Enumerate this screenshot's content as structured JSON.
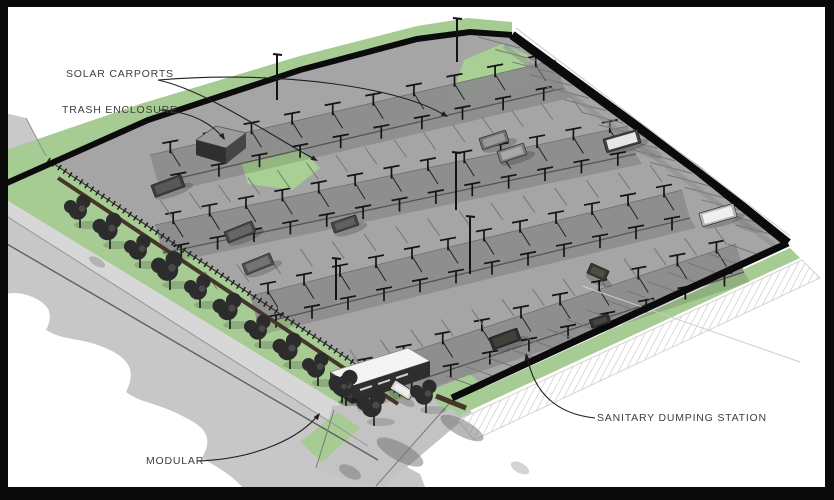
{
  "labels": [
    {
      "id": "solar-carports",
      "text": "SOLAR CARPORTS",
      "x": 66,
      "y": 68
    },
    {
      "id": "trash-enclosure",
      "text": "TRASH ENCLOSURE",
      "x": 62,
      "y": 104
    },
    {
      "id": "modular",
      "text": "MODULAR",
      "x": 146,
      "y": 455
    },
    {
      "id": "sanitary-dumping-station",
      "text": "SANITARY DUMPING STATION",
      "x": 597,
      "y": 412
    }
  ],
  "colors": {
    "frame": "#0a0a0a",
    "background": "#ffffff",
    "grass": "#a6cb93",
    "grass_light": "#a9d094",
    "pavement": "#a5a5a5",
    "band": "#8d8d8d",
    "road": "#c7c7c7",
    "sidewalk": "#d7d7d7",
    "wall": "#0b0b0b",
    "hedge": "#46362a",
    "label_text": "#3d3d3d",
    "leader": "#1f1f1f"
  },
  "scene": {
    "frame": {
      "top": 7,
      "bottom": 13,
      "left": 8,
      "right": 9
    },
    "ground": [
      {
        "name": "road-upper-wedge",
        "fill": "#c9c9c9",
        "pts": [
          [
            0,
            112
          ],
          [
            26,
            118
          ],
          [
            48,
            158
          ],
          [
            0,
            170
          ]
        ]
      },
      {
        "name": "lot-pavement",
        "fill": "#a5a5a5",
        "pts": [
          [
            40,
            153
          ],
          [
            148,
            120
          ],
          [
            300,
            70
          ],
          [
            417,
            39
          ],
          [
            470,
            32
          ],
          [
            510,
            35
          ],
          [
            697,
            170
          ],
          [
            788,
            243
          ],
          [
            452,
            398
          ],
          [
            412,
            406
          ],
          [
            48,
            162
          ]
        ]
      },
      {
        "name": "nw-green-band",
        "fill": "#a6cb93",
        "pts": [
          [
            0,
            152
          ],
          [
            140,
            104
          ],
          [
            300,
            56
          ],
          [
            417,
            26
          ],
          [
            468,
            18
          ],
          [
            512,
            22
          ],
          [
            512,
            35
          ],
          [
            470,
            32
          ],
          [
            417,
            39
          ],
          [
            300,
            70
          ],
          [
            148,
            120
          ],
          [
            0,
            186
          ]
        ]
      },
      {
        "name": "top-corner-grass",
        "fill": "#a9d094",
        "pts": [
          [
            452,
            96
          ],
          [
            464,
            60
          ],
          [
            502,
            44
          ],
          [
            530,
            56
          ],
          [
            526,
            82
          ],
          [
            468,
            102
          ]
        ]
      },
      {
        "name": "trash-grass",
        "fill": "#a9d094",
        "pts": [
          [
            240,
            158
          ],
          [
            298,
            146
          ],
          [
            320,
            168
          ],
          [
            292,
            190
          ],
          [
            248,
            184
          ]
        ]
      },
      {
        "name": "sw-green-strip",
        "fill": "#a6cb93",
        "pts": [
          [
            44,
            156
          ],
          [
            408,
            400
          ],
          [
            382,
            430
          ],
          [
            0,
            196
          ],
          [
            0,
            186
          ]
        ]
      },
      {
        "name": "sidewalk",
        "fill": "#d7d7d7",
        "pts": [
          [
            0,
            196
          ],
          [
            382,
            430
          ],
          [
            368,
            446
          ],
          [
            0,
            212
          ]
        ]
      },
      {
        "name": "road",
        "fill": "#c7c7c7",
        "path": "M 0 212 L 368 446 L 420 474 L 430 500 L 252 500 C 238 478 222 470 202 458 C 212 440 208 430 190 420 C 158 402 142 404 126 392 C 136 372 130 360 110 350 C 80 336 66 342 46 330 C 54 314 50 304 30 296 C 20 292 8 292 0 296 Z"
      },
      {
        "name": "entrance-drive",
        "fill": "#c3c3c3",
        "pts": [
          [
            332,
            406
          ],
          [
            452,
            394
          ],
          [
            472,
            412
          ],
          [
            380,
            490
          ],
          [
            318,
            470
          ]
        ]
      },
      {
        "name": "entrance-grass-left",
        "fill": "#a6cb93",
        "pts": [
          [
            300,
            442
          ],
          [
            338,
            412
          ],
          [
            360,
            428
          ],
          [
            322,
            462
          ]
        ]
      },
      {
        "name": "entrance-grass-right",
        "fill": "#a6cb93",
        "pts": [
          [
            428,
            392
          ],
          [
            470,
            374
          ],
          [
            488,
            390
          ],
          [
            445,
            412
          ]
        ]
      },
      {
        "name": "se-green-strip",
        "fill": "#a6cb93",
        "pts": [
          [
            448,
            404
          ],
          [
            790,
            248
          ],
          [
            800,
            258
          ],
          [
            458,
            416
          ]
        ]
      },
      {
        "name": "hatch-band",
        "fill": "pattern",
        "stroke": "#d4d4d4",
        "pts": [
          [
            458,
            420
          ],
          [
            802,
            260
          ],
          [
            820,
            278
          ],
          [
            474,
            440
          ]
        ]
      }
    ],
    "bands": [
      {
        "name": "carport-row-1",
        "x1": 150,
        "y1": 155,
        "x2": 556,
        "y2": 60,
        "units": 10
      },
      {
        "name": "carport-row-2",
        "x1": 155,
        "y1": 225,
        "x2": 628,
        "y2": 126,
        "units": 13
      },
      {
        "name": "carport-row-3",
        "x1": 250,
        "y1": 296,
        "x2": 682,
        "y2": 190,
        "units": 12
      },
      {
        "name": "carport-row-4",
        "x1": 345,
        "y1": 374,
        "x2": 736,
        "y2": 244,
        "units": 10
      }
    ],
    "band_w": [
      8,
      28
    ],
    "stripes": [
      {
        "name": "stalls-ne",
        "x1": 520,
        "y1": 48,
        "x2": 778,
        "y2": 236,
        "count": 16,
        "dx": -42,
        "dy": -11
      },
      {
        "name": "stalls-se",
        "x1": 480,
        "y1": 388,
        "x2": 762,
        "y2": 256,
        "count": 15,
        "dx": -34,
        "dy": -12
      },
      {
        "name": "stalls-aisle-1",
        "x1": 160,
        "y1": 200,
        "x2": 570,
        "y2": 95,
        "count": 15,
        "dx": 12,
        "dy": 17
      },
      {
        "name": "stalls-aisle-2",
        "x1": 205,
        "y1": 272,
        "x2": 650,
        "y2": 165,
        "count": 15,
        "dx": 12,
        "dy": 17
      },
      {
        "name": "stalls-aisle-3",
        "x1": 350,
        "y1": 350,
        "x2": 715,
        "y2": 228,
        "count": 13,
        "dx": 12,
        "dy": 17
      }
    ],
    "lines": [
      {
        "name": "wedge-edge",
        "pts": [
          [
            26,
            118
          ],
          [
            46,
            156
          ]
        ],
        "stroke": "#8f8f8f",
        "w": 1
      },
      {
        "name": "road-curb",
        "pts": [
          [
            0,
            212
          ],
          [
            368,
            446
          ]
        ],
        "stroke": "#969696",
        "w": 1
      },
      {
        "name": "road-centerline",
        "pts": [
          [
            0,
            240
          ],
          [
            378,
            460
          ]
        ],
        "stroke": "#5f5f5f",
        "w": 1.4
      },
      {
        "name": "drive-edge-left",
        "pts": [
          [
            334,
            410
          ],
          [
            316,
            468
          ]
        ],
        "stroke": "#7a7a7a",
        "w": 1
      },
      {
        "name": "drive-edge-right",
        "pts": [
          [
            454,
            398
          ],
          [
            376,
            486
          ]
        ],
        "stroke": "#7a7a7a",
        "w": 1
      },
      {
        "name": "se-strip-highlight",
        "pts": [
          [
            450,
            400
          ],
          [
            788,
            245
          ]
        ],
        "stroke": "#cfe3c4",
        "w": 1.5
      },
      {
        "name": "ne-wall-inner-shadow",
        "pts": [
          [
            504,
            46
          ],
          [
            778,
            248
          ]
        ],
        "stroke": "#8a8a8a",
        "w": 5,
        "op": 0.5
      },
      {
        "name": "hedge-wall",
        "pts": [
          [
            58,
            178
          ],
          [
            398,
            404
          ]
        ],
        "stroke": "#46362a",
        "w": 4
      },
      {
        "name": "hedge-wall-entrance",
        "pts": [
          [
            436,
            396
          ],
          [
            466,
            408
          ]
        ],
        "stroke": "#46362a",
        "w": 5
      },
      {
        "name": "sw-fence-rail",
        "pts": [
          [
            48,
            160
          ],
          [
            404,
            396
          ]
        ],
        "stroke": "#333333",
        "w": 1.2
      },
      {
        "name": "sw-fence-posts",
        "pts": [
          [
            48,
            160
          ],
          [
            404,
            396
          ]
        ],
        "stroke": "#1d1d1d",
        "w": 6,
        "dash": "1.5,5"
      },
      {
        "name": "utility-line",
        "pts": [
          [
            582,
            286
          ],
          [
            800,
            362
          ]
        ],
        "stroke": "#cccccc",
        "w": 1
      },
      {
        "name": "nw-wall",
        "pts": [
          [
            0,
            186
          ],
          [
            148,
            120
          ],
          [
            300,
            70
          ],
          [
            417,
            39
          ],
          [
            470,
            32
          ],
          [
            512,
            35
          ]
        ],
        "stroke": "#0b0b0b",
        "w": 6
      },
      {
        "name": "ne-wall",
        "pts": [
          [
            512,
            35
          ],
          [
            697,
            170
          ],
          [
            788,
            243
          ]
        ],
        "stroke": "#0b0b0b",
        "w": 9
      },
      {
        "name": "ne-wall-cap",
        "pts": [
          [
            516,
            28
          ],
          [
            790,
            236
          ]
        ],
        "stroke": "#d2d2d2",
        "w": 1.2
      },
      {
        "name": "se-wall",
        "pts": [
          [
            788,
            243
          ],
          [
            452,
            398
          ]
        ],
        "stroke": "#0b0b0b",
        "w": 7
      }
    ],
    "buildings": [
      {
        "name": "trash-enclosure-roof",
        "fill": "#9b9b9b",
        "stroke": "#555555",
        "pts": [
          [
            196,
            140
          ],
          [
            216,
            126
          ],
          [
            246,
            133
          ],
          [
            226,
            148
          ]
        ]
      },
      {
        "name": "trash-enclosure-front",
        "fill": "#2f2f2f",
        "pts": [
          [
            196,
            140
          ],
          [
            226,
            148
          ],
          [
            226,
            164
          ],
          [
            196,
            155
          ]
        ]
      },
      {
        "name": "trash-enclosure-side",
        "fill": "#454545",
        "pts": [
          [
            226,
            148
          ],
          [
            246,
            133
          ],
          [
            246,
            148
          ],
          [
            226,
            164
          ]
        ]
      },
      {
        "name": "modular-roof",
        "fill": "#f4f4f4",
        "stroke": "#8a8a8a",
        "pts": [
          [
            330,
            372
          ],
          [
            408,
            348
          ],
          [
            430,
            361
          ],
          [
            352,
            386
          ]
        ]
      },
      {
        "name": "modular-front",
        "fill": "#3a3a3a",
        "pts": [
          [
            330,
            372
          ],
          [
            352,
            386
          ],
          [
            352,
            404
          ],
          [
            330,
            389
          ]
        ]
      },
      {
        "name": "modular-side",
        "fill": "#2e2e2e",
        "pts": [
          [
            352,
            386
          ],
          [
            430,
            361
          ],
          [
            430,
            376
          ],
          [
            352,
            404
          ]
        ]
      }
    ],
    "windows": [
      {
        "pts": [
          [
            360,
            390
          ],
          [
            372,
            386
          ]
        ]
      },
      {
        "pts": [
          [
            378,
            384
          ],
          [
            390,
            380
          ]
        ]
      },
      {
        "pts": [
          [
            396,
            378
          ],
          [
            408,
            374
          ]
        ]
      }
    ],
    "blobs": [
      {
        "x": 400,
        "y": 452,
        "rx": 26,
        "ry": 9,
        "rot": 28,
        "op": 0.5
      },
      {
        "x": 462,
        "y": 428,
        "rx": 24,
        "ry": 8,
        "rot": 28,
        "op": 0.5
      },
      {
        "x": 350,
        "y": 472,
        "rx": 12,
        "ry": 6,
        "rot": 28,
        "op": 0.45
      },
      {
        "x": 648,
        "y": 152,
        "rx": 15,
        "ry": 5,
        "rot": 18,
        "op": 0.3
      },
      {
        "x": 748,
        "y": 226,
        "rx": 16,
        "ry": 5,
        "rot": 18,
        "op": 0.3
      },
      {
        "x": 97,
        "y": 262,
        "rx": 9,
        "ry": 4,
        "rot": 30,
        "op": 0.35
      },
      {
        "x": 520,
        "y": 468,
        "rx": 10,
        "ry": 5,
        "rot": 28,
        "op": 0.3
      }
    ],
    "vehicles": [
      {
        "x": 168,
        "y": 186,
        "a": -20,
        "l": 32,
        "w": 13,
        "body": "#3c3c3c",
        "top": "#585858"
      },
      {
        "x": 240,
        "y": 232,
        "a": -22,
        "l": 30,
        "w": 12,
        "body": "#474747",
        "top": "#666666"
      },
      {
        "x": 258,
        "y": 264,
        "a": -22,
        "l": 30,
        "w": 12,
        "body": "#515151",
        "top": "#737373"
      },
      {
        "x": 345,
        "y": 224,
        "a": -18,
        "l": 26,
        "w": 11,
        "body": "#454545",
        "top": "#606060"
      },
      {
        "x": 402,
        "y": 390,
        "a": 32,
        "l": 22,
        "w": 10,
        "body": "#d6d6d6",
        "top": "#efefef"
      },
      {
        "x": 494,
        "y": 140,
        "a": -18,
        "l": 28,
        "w": 12,
        "body": "#6f6f6f",
        "top": "#9a9a9a"
      },
      {
        "x": 512,
        "y": 153,
        "a": -18,
        "l": 28,
        "w": 12,
        "body": "#7c7c7c",
        "top": "#a8a8a8"
      },
      {
        "x": 622,
        "y": 141,
        "a": -16,
        "l": 36,
        "w": 14,
        "body": "#3f3f3f",
        "top": "#e6e6e6"
      },
      {
        "x": 718,
        "y": 215,
        "a": -16,
        "l": 36,
        "w": 14,
        "body": "#b5b5b5",
        "top": "#efefef"
      },
      {
        "x": 505,
        "y": 339,
        "a": -20,
        "l": 30,
        "w": 13,
        "body": "#2c2f28",
        "top": "#3e4138"
      },
      {
        "x": 600,
        "y": 321,
        "a": -18,
        "l": 20,
        "w": 9,
        "body": "#303030",
        "top": "#454545"
      },
      {
        "x": 598,
        "y": 272,
        "a": 24,
        "l": 20,
        "w": 11,
        "body": "#333a2c",
        "top": "#4a5140"
      }
    ],
    "trees": [
      [
        80,
        213,
        11
      ],
      [
        110,
        233,
        12
      ],
      [
        140,
        253,
        11
      ],
      [
        170,
        273,
        13
      ],
      [
        200,
        293,
        11
      ],
      [
        230,
        313,
        12
      ],
      [
        260,
        333,
        11
      ],
      [
        290,
        353,
        12
      ],
      [
        318,
        371,
        11
      ],
      [
        346,
        390,
        12
      ],
      [
        374,
        410,
        12
      ],
      [
        426,
        398,
        11
      ],
      [
        342,
        390,
        9
      ]
    ],
    "poles": [
      [
        277,
        100,
        46
      ],
      [
        457,
        62,
        44
      ],
      [
        456,
        210,
        58
      ],
      [
        470,
        274,
        58
      ],
      [
        336,
        300,
        42
      ]
    ],
    "leaders": [
      {
        "name": "leader-solar-1",
        "d": "M158,80 C205,90 272,136 316,160",
        "end": [
          318,
          161
        ],
        "dir": [
          0.88,
          0.48
        ]
      },
      {
        "name": "leader-solar-2",
        "d": "M158,80 C285,70 402,88 446,116",
        "end": [
          448,
          117
        ],
        "dir": [
          0.84,
          0.53
        ]
      },
      {
        "name": "leader-trash",
        "d": "M160,110 C196,112 215,127 224,139",
        "end": [
          225,
          140
        ],
        "dir": [
          0.55,
          0.83
        ]
      },
      {
        "name": "leader-modular",
        "d": "M197,461 C258,459 301,437 319,414",
        "end": [
          320,
          413
        ],
        "dir": [
          0.61,
          -0.79
        ]
      },
      {
        "name": "leader-sanitary",
        "d": "M595,418 C556,414 533,392 527,355",
        "end": [
          526,
          353
        ],
        "dir": [
          -0.16,
          -0.99
        ]
      }
    ]
  }
}
